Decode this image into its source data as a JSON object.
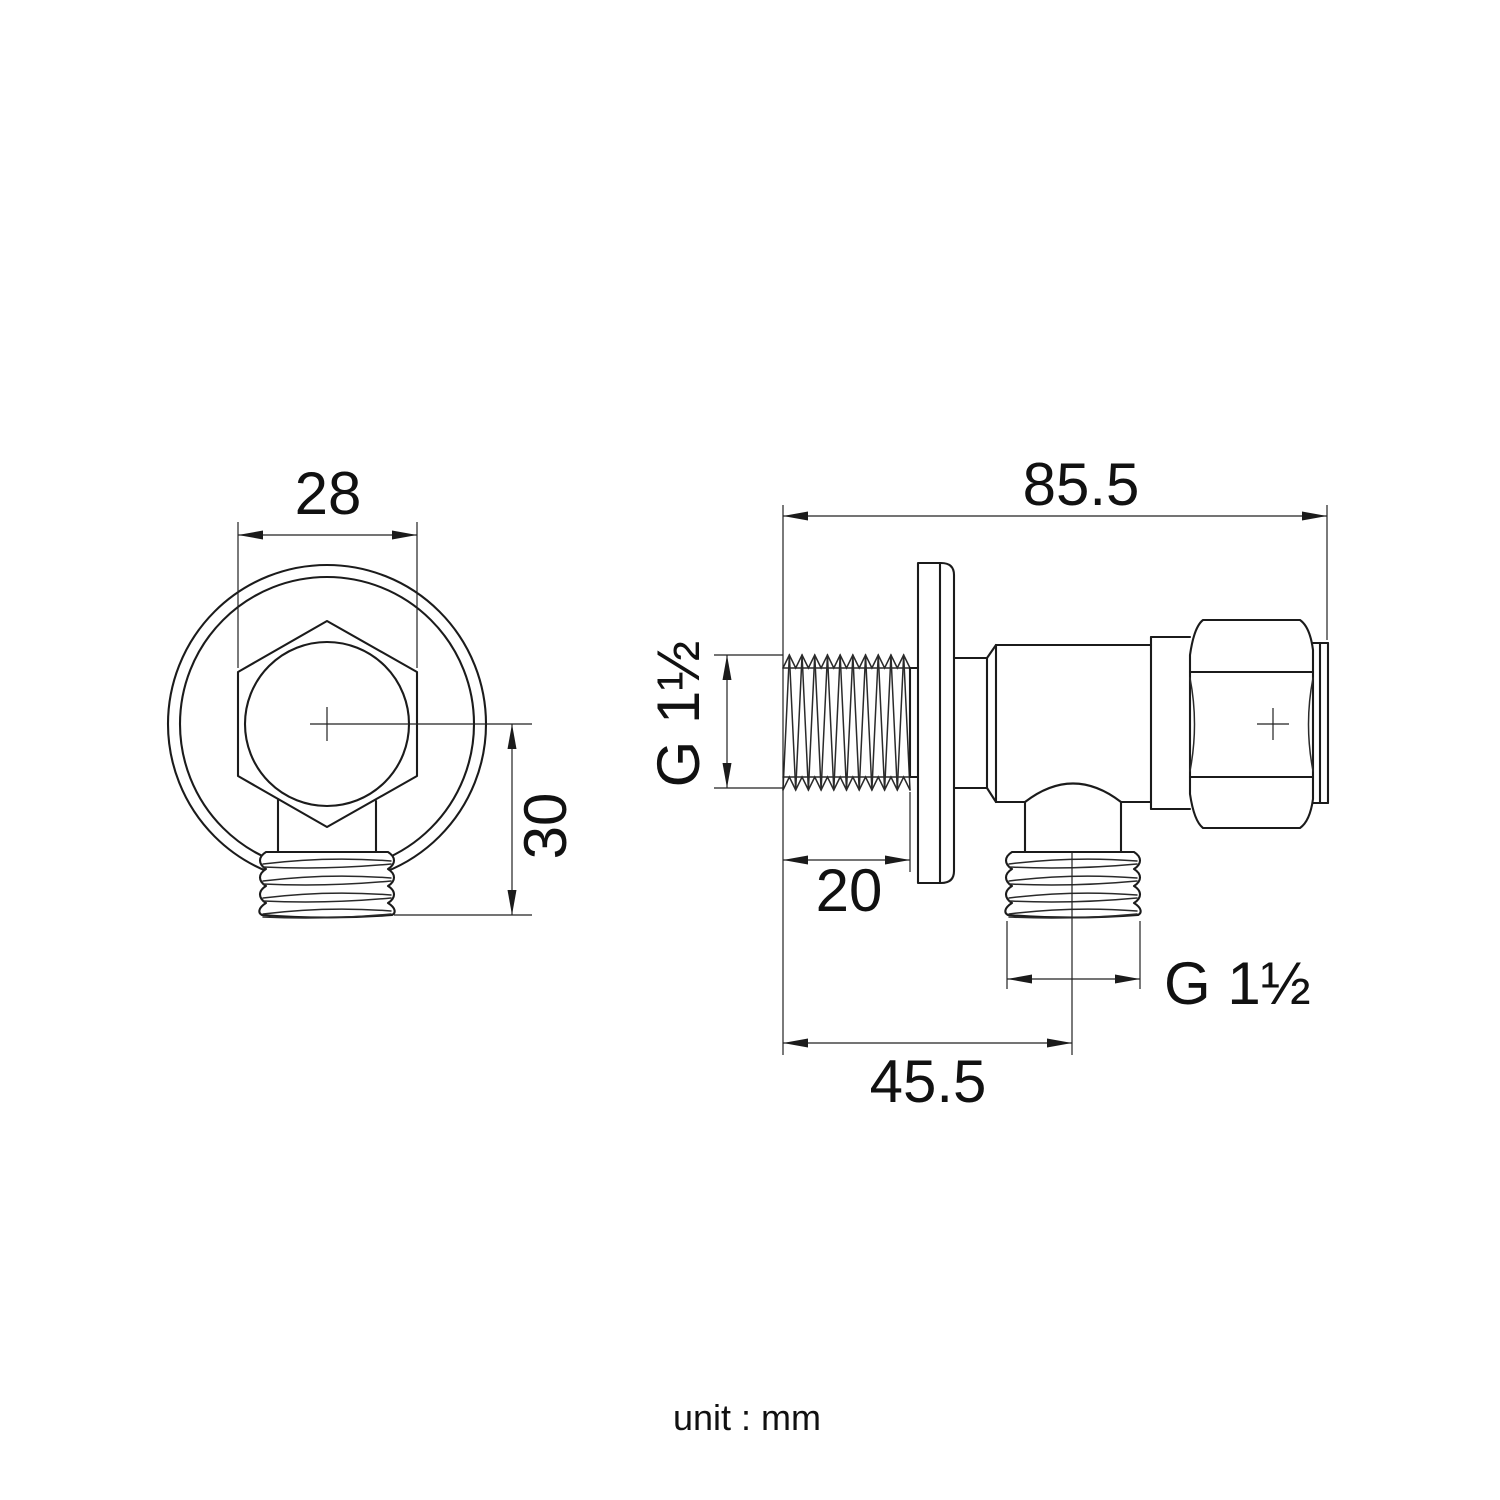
{
  "page": {
    "background": "#ffffff",
    "line_color": "#1b1b1b"
  },
  "front_view": {
    "dims": {
      "width_across_flats": "28",
      "center_to_outlet": "30"
    }
  },
  "side_view": {
    "dims": {
      "overall_length": "85.5",
      "inlet_thread_length": "20",
      "outlet_center_offset": "45.5",
      "inlet_thread_size": "G 1½",
      "outlet_thread_size": "G 1½"
    }
  },
  "footer": {
    "unit_note": "unit : mm"
  }
}
